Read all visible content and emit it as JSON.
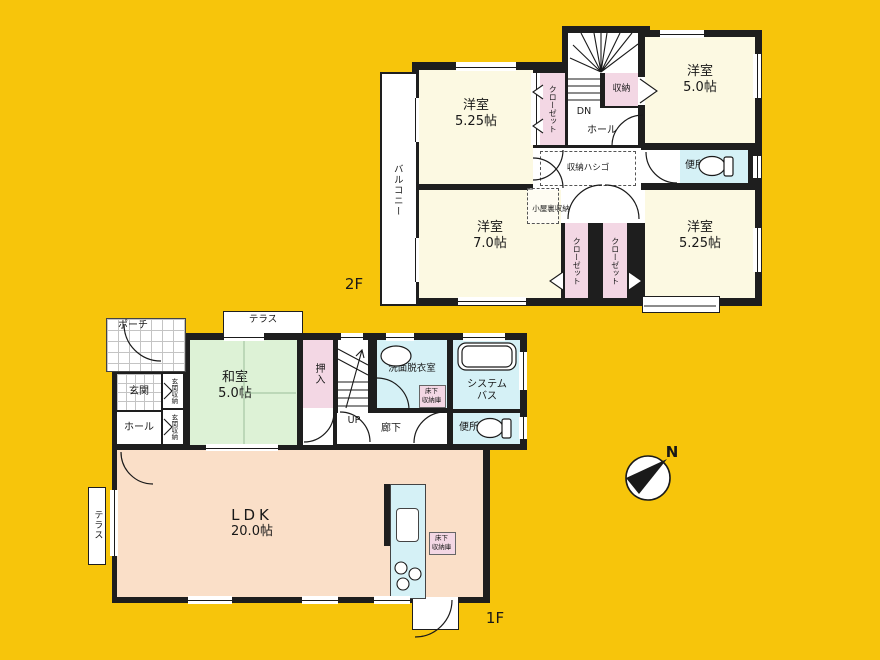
{
  "colors": {
    "background": "#F7C50B",
    "wall": "#1E1E1E",
    "room_cream": "#FCF9E2",
    "closet_pink": "#F3D7E4",
    "wet_area_blue": "#D5F1F6",
    "tatami_green": "#DDF2D6",
    "ldk_peach": "#FADFC8"
  },
  "floor2": {
    "label": "2F",
    "balcony": "バルコニー",
    "room_a": {
      "name": "洋室",
      "size": "5.25帖"
    },
    "closet": "クローゼット",
    "stairs_dn": "DN",
    "hall": "ホール",
    "storage": "収納",
    "room_b": {
      "name": "洋室",
      "size": "5.0帖"
    },
    "toilet": "便所",
    "storage_ladder": "収納ハシゴ",
    "attic_storage": "小屋裏収納",
    "room_c": {
      "name": "洋室",
      "size": "7.0帖"
    },
    "room_d": {
      "name": "洋室",
      "size": "5.25帖"
    }
  },
  "floor1": {
    "label": "1F",
    "porch": "ポーチ",
    "terrace": "テラス",
    "entrance": "玄関",
    "entrance_storage": "玄関収納",
    "hall": "ホール",
    "washitsu": {
      "name": "和室",
      "size": "5.0帖"
    },
    "oshiire": "押入",
    "stairs_up": "UP",
    "washroom": "洗面脱衣室",
    "underfloor_storage": {
      "line1": "床下",
      "line2": "収納庫"
    },
    "system_bath": {
      "line1": "システム",
      "line2": "バス"
    },
    "corridor": "廊下",
    "toilet": "便所",
    "ldk": {
      "name": "LDK",
      "size": "20.0帖"
    }
  },
  "compass": {
    "north": "N"
  }
}
